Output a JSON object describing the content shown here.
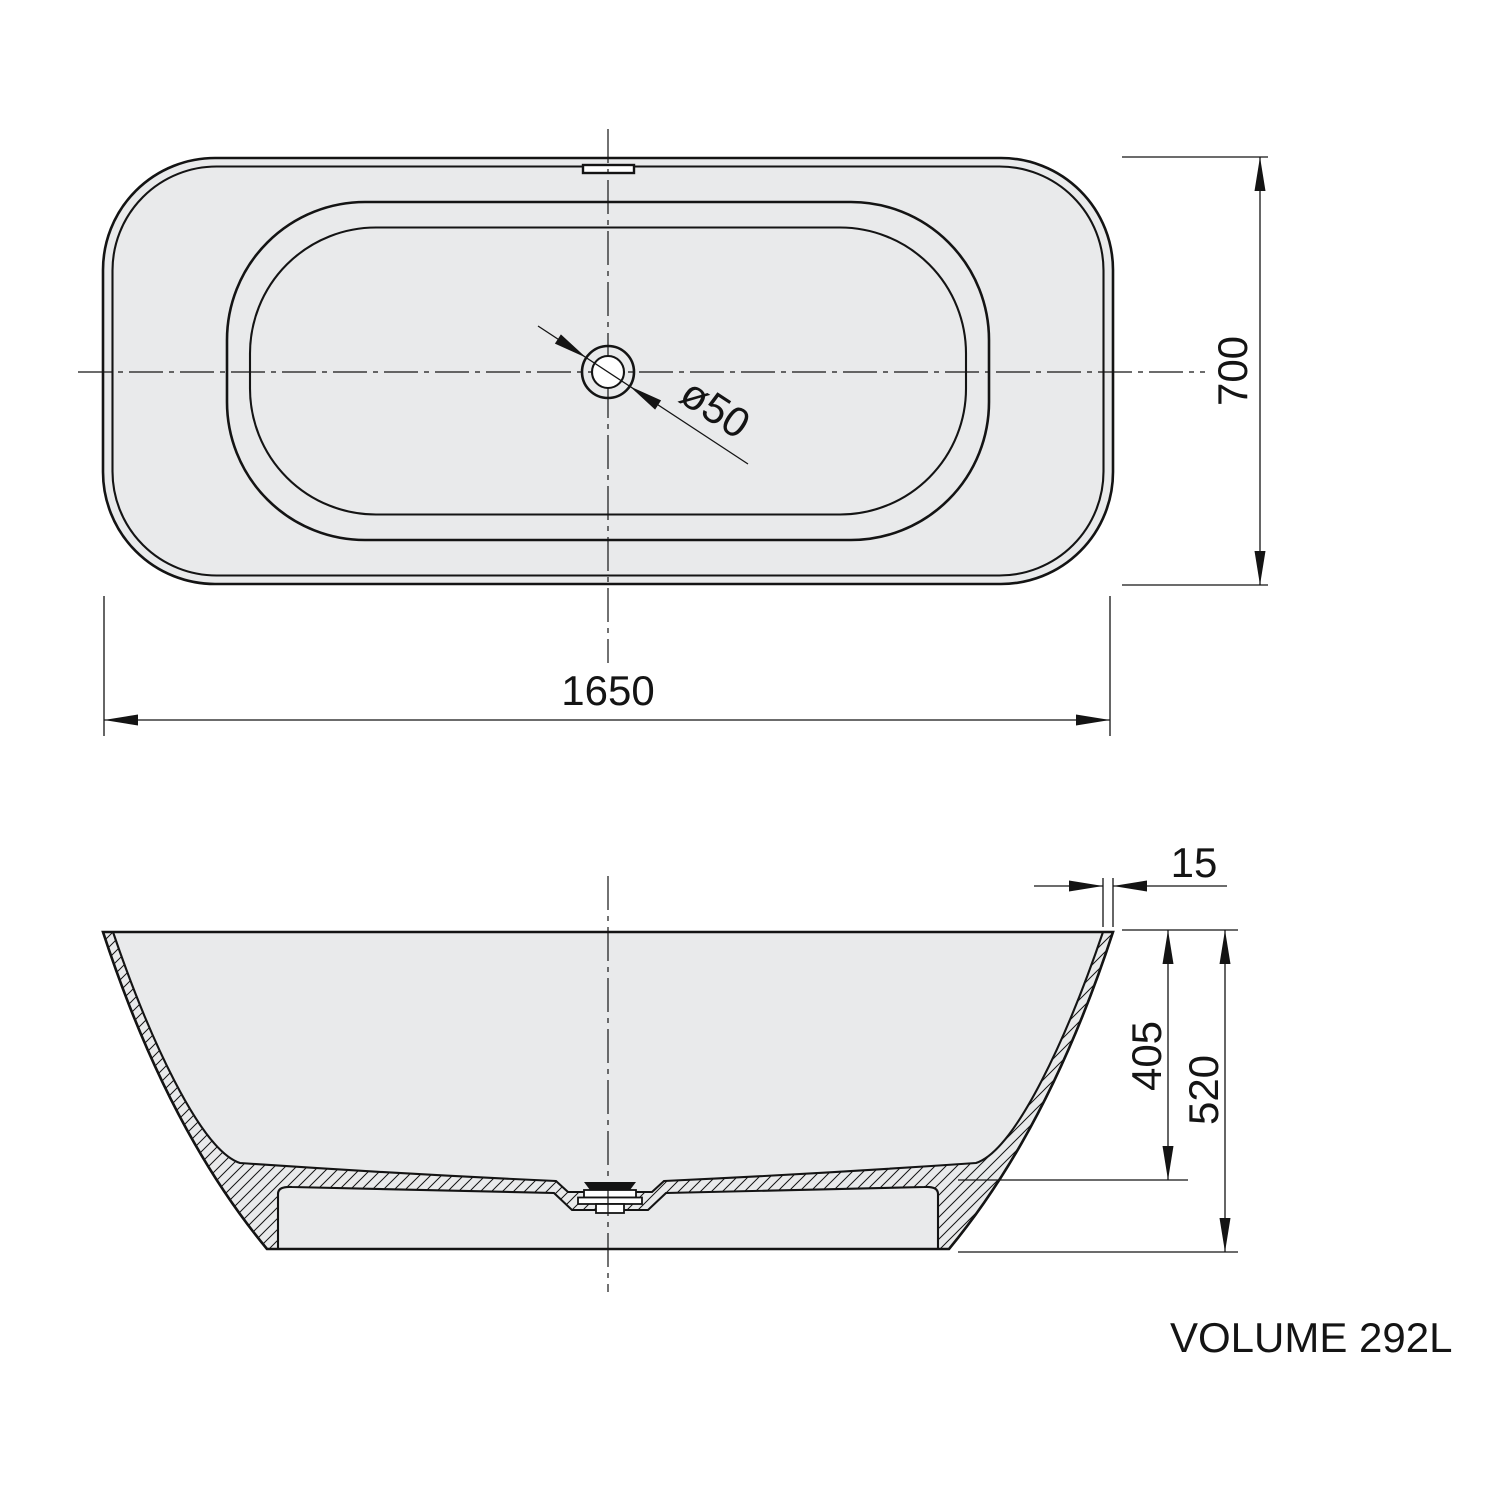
{
  "colors": {
    "bg": "#ffffff",
    "line": "#141414",
    "fill": "#e9eaeb"
  },
  "top_view": {
    "length_dim": "1650",
    "width_dim": "700",
    "drain_dim": "ø50"
  },
  "section_view": {
    "wall_thickness_dim": "15",
    "depth_dim": "405",
    "height_dim": "520"
  },
  "footer": {
    "volume_label": "VOLUME 292L"
  }
}
